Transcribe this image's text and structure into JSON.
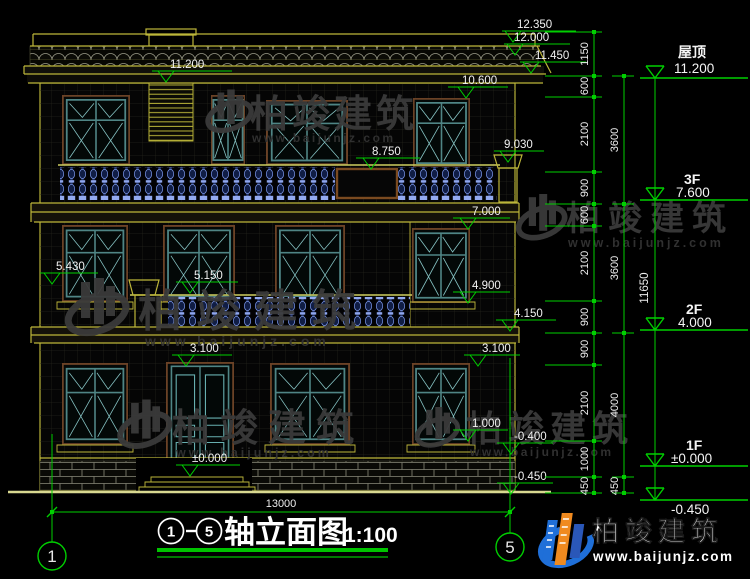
{
  "colors": {
    "dim_green": "#00cf00",
    "line_yellow": "#bdb63a",
    "frame_teal": "#4f8585",
    "frame_brown": "#6b4226",
    "baluster_blue": "#7b97ea",
    "text_white": "#f2f2f2",
    "watermark_gray": "#3a3a3a",
    "logo_blue": "#1f6fd8",
    "logo_orange": "#f08a1f",
    "underline_green": "#00c400"
  },
  "title": {
    "axis_from": "1",
    "axis_to": "5",
    "text": "轴立面图",
    "scale": "1:100"
  },
  "axes": {
    "left": "1",
    "right": "5"
  },
  "elevations": [
    "12.350",
    "12.000",
    "11.450",
    "11.200",
    "10.600",
    "9.030",
    "8.750",
    "7.000",
    "5.430",
    "5.150",
    "4.900",
    "4.150",
    "3.100",
    "3.100",
    "1.000",
    "±0.000",
    "-0.400",
    "-0.450"
  ],
  "floors": [
    {
      "name": "屋顶",
      "elev": "11.200"
    },
    {
      "name": "3F",
      "elev": "7.600"
    },
    {
      "name": "2F",
      "elev": "4.000"
    },
    {
      "name": "1F",
      "elev": "±0.000"
    },
    {
      "name": "",
      "elev": "-0.450"
    }
  ],
  "dims": {
    "inner": [
      "1150",
      "600",
      "2100",
      "900",
      "600",
      "2100",
      "900",
      "900",
      "2100",
      "1000",
      "450"
    ],
    "outer": [
      "3600",
      "3600",
      "4000",
      "450"
    ],
    "total": "11650",
    "width": "13000"
  },
  "watermark": {
    "brand": "柏竣建筑",
    "url": "www.baijunjz.com"
  },
  "logo": {
    "brand": "柏竣建筑",
    "url": "www.baijunjz.com"
  }
}
